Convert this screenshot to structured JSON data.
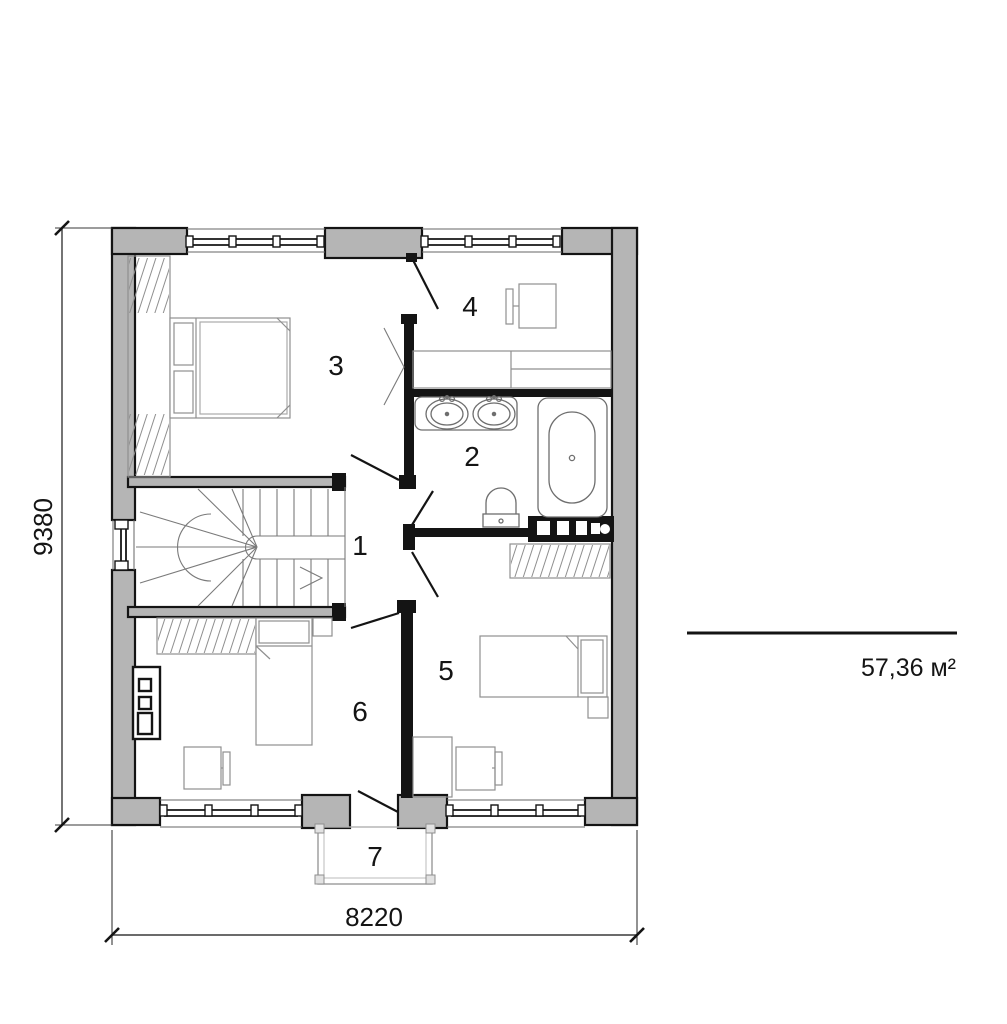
{
  "plan": {
    "area_label": "57,36 м²",
    "dimensions": {
      "width_total": "8220",
      "height_total": "9380"
    },
    "rooms": [
      {
        "number": "1"
      },
      {
        "number": "2"
      },
      {
        "number": "3"
      },
      {
        "number": "4"
      },
      {
        "number": "5"
      },
      {
        "number": "6"
      },
      {
        "number": "7"
      }
    ],
    "colors": {
      "wall_fill": "#b5b5b5",
      "wall_line": "#141414",
      "furniture_line": "#8f8f8f",
      "background": "#ffffff"
    },
    "symbols": [
      "double-bed",
      "single-bed",
      "wardrobe",
      "staircase",
      "bathtub",
      "sink",
      "toilet",
      "desk",
      "radiator",
      "chimney-shaft",
      "balcony",
      "window",
      "door-swing",
      "dimension-line",
      "scale-line"
    ]
  }
}
